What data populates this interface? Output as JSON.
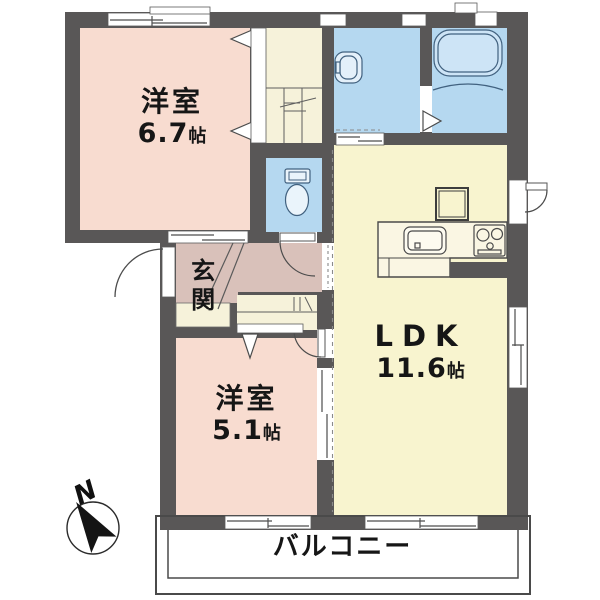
{
  "rooms": {
    "west_room_1": {
      "name": "洋室",
      "size": "6.7",
      "unit": "帖"
    },
    "west_room_2": {
      "name": "洋室",
      "size": "5.1",
      "unit": "帖"
    },
    "ldk": {
      "name": "LDK",
      "size": "11.6",
      "unit": "帖"
    },
    "entrance": {
      "name": "玄関"
    },
    "balcony": {
      "name": "バルコニー"
    }
  },
  "compass": {
    "north_label": "N"
  },
  "colors": {
    "wall": "#595757",
    "room_pink": "#f8dcd0",
    "room_yellow": "#f8f4cf",
    "water_blue": "#b5d8f0",
    "hall_mauve": "#d9c1ba",
    "closet_cream": "#f6f2da"
  }
}
